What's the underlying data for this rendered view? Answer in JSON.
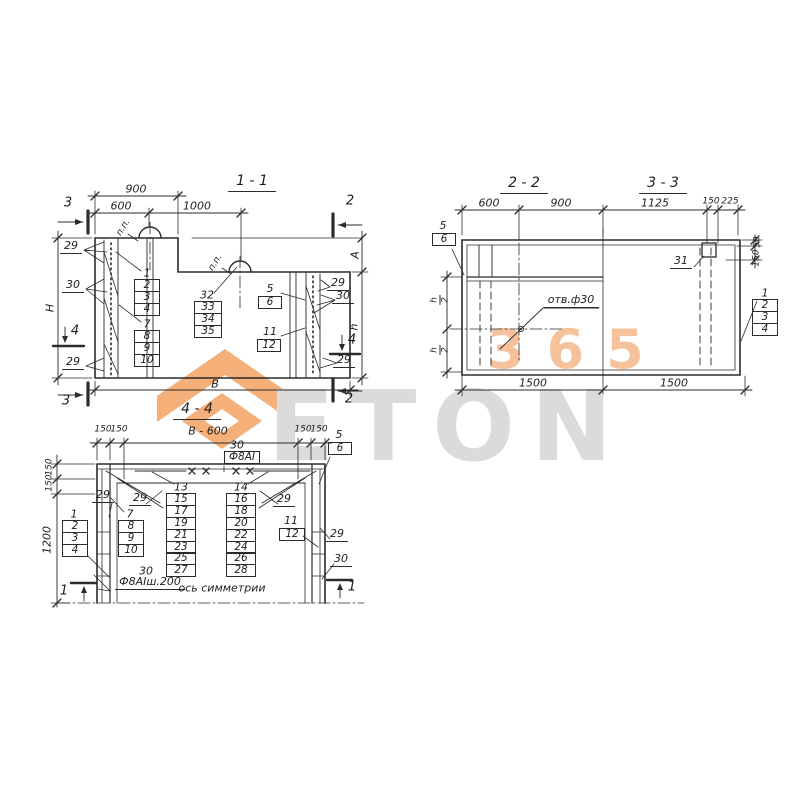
{
  "watermark": {
    "digits": "365",
    "word": "ETON"
  },
  "sections": {
    "s11": {
      "title": "1 - 1",
      "dims": {
        "d900": "900",
        "d600": "600",
        "d1000": "1000",
        "width": "В",
        "height": "Н",
        "a": "А",
        "h": "h"
      },
      "loop_label_1": "п.п.",
      "loop_label_2": "п.п.",
      "markers": {
        "m3_top": "3",
        "m2_top": "2",
        "m3_bot": "3",
        "m2_bot": "2",
        "m4_left": "4",
        "m4_right": "4"
      },
      "callouts": {
        "c29_tl": "29",
        "c30_l": "30",
        "c29_bl": "29",
        "c29_tr": "29",
        "c30_r": "30",
        "c29_br": "29"
      },
      "stacks": {
        "s1_head": "1",
        "s1": [
          "2",
          "3",
          "4"
        ],
        "s2_head": "7",
        "s2": [
          "8",
          "9",
          "10"
        ],
        "s3_head": "32",
        "s3": [
          "33",
          "34",
          "35"
        ],
        "s4_head": "5",
        "s4": [
          "6"
        ],
        "s5_head": "11",
        "s5": [
          "12"
        ]
      }
    },
    "s22": {
      "title": "2 - 2",
      "dims": {
        "d600": "600",
        "d900": "900",
        "d1500": "1500",
        "h_num": "h",
        "h_den": "2"
      },
      "hole_label": "отв.ф30",
      "stacks": {
        "s1_head": "5",
        "s1": [
          "6"
        ]
      }
    },
    "s33": {
      "title": "3 - 3",
      "dims": {
        "d1125": "1125",
        "d150": "150",
        "d225": "225",
        "d50_v": "50",
        "d150_v": "150",
        "d1500": "1500"
      },
      "callouts": {
        "c31": "31"
      },
      "stacks": {
        "s1_head": "1",
        "s1": [
          "2",
          "3",
          "4"
        ]
      }
    },
    "s44": {
      "title": "4 - 4",
      "dims": {
        "b600": "В - 600",
        "d150_a": "150",
        "d150_b": "150",
        "d150_c": "150",
        "d150_d": "150",
        "d150_v1": "150",
        "d150_v2": "150",
        "d1200": "1200"
      },
      "labels": {
        "n30_top": "30",
        "f8_top": "Ф8АI",
        "n30_bot": "30",
        "f8_bot": "Ф8АIш.200",
        "axis": "ось симметрии"
      },
      "markers": {
        "m1_left": "1",
        "m1_right": "1"
      },
      "callouts": {
        "c29_l": "29",
        "c29_cl": "29",
        "c29_cr": "29",
        "c29_r": "29",
        "c30_r": "30"
      },
      "stacks": {
        "s1_head": "1",
        "s1": [
          "2",
          "3",
          "4"
        ],
        "s2_head": "7",
        "s2": [
          "8",
          "9",
          "10"
        ],
        "s3_head": "13",
        "s3": [
          "15",
          "17",
          "19",
          "21",
          "23",
          "25",
          "27"
        ],
        "s4_head": "14",
        "s4": [
          "16",
          "18",
          "20",
          "22",
          "24",
          "26",
          "28"
        ],
        "s5_head": "11",
        "s5": [
          "12"
        ],
        "s6_head": "5",
        "s6": [
          "6"
        ]
      }
    }
  }
}
